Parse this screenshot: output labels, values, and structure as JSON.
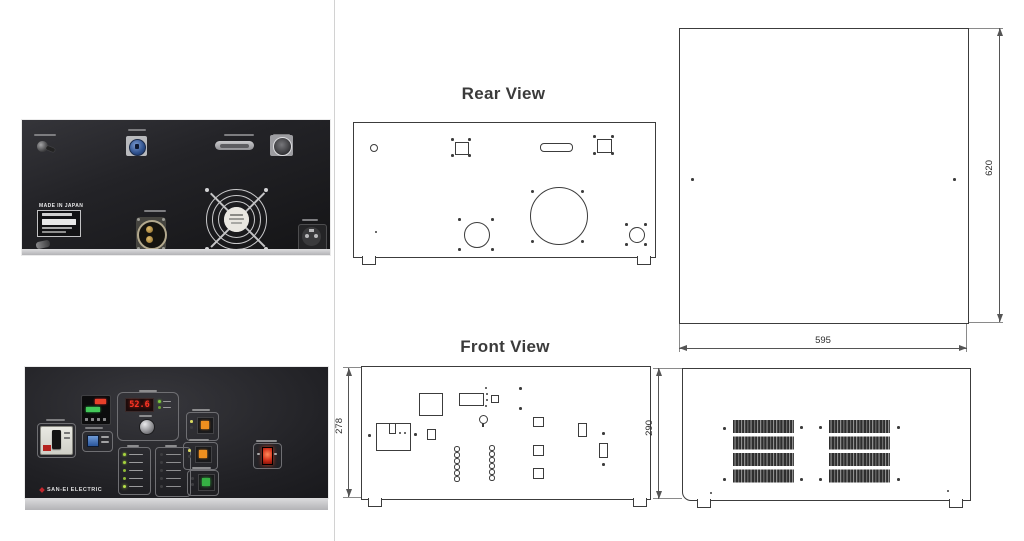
{
  "drawings": {
    "rear": {
      "title": "Rear View"
    },
    "front": {
      "title": "Front View",
      "height_mm": "278"
    },
    "top": {
      "depth_mm": "620",
      "width_mm": "595"
    },
    "side": {
      "height_mm": "290"
    }
  },
  "photos": {
    "rear": {
      "origin_label": "MADE IN JAPAN"
    },
    "front": {
      "brand": "SAN-EI ELECTRIC",
      "power_display": "52.6"
    }
  },
  "palette": {
    "line": "#3c3c3c",
    "dim_line": "#555555",
    "panel_black": "#1b1b1e",
    "accent_red": "#c1272d",
    "led_green": "#9ccf3a",
    "button_orange": "#ef8f1f",
    "button_green": "#35b043",
    "display_red": "#ff3526",
    "connector_blue": "#2d4f8c"
  }
}
